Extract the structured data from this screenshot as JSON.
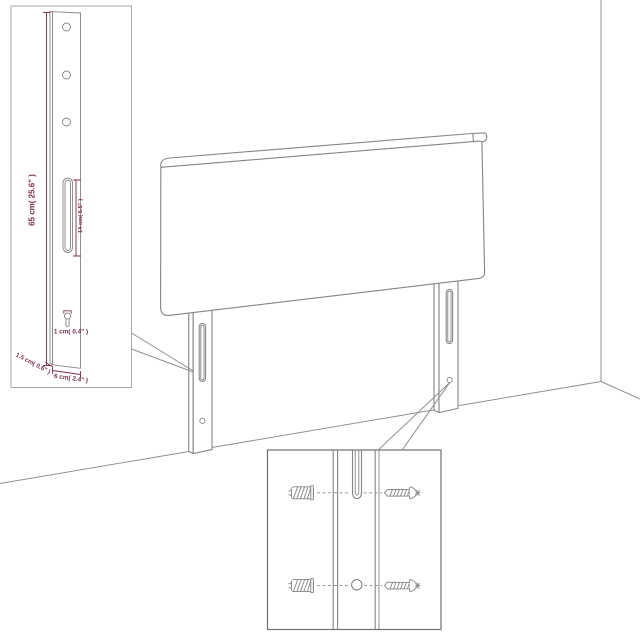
{
  "colors": {
    "background": "#ffffff",
    "outline": "#858585",
    "wall": "#909090",
    "dimension": "#7d2b50",
    "callout_border_light": "#ababab",
    "callout_border_dark": "#6f6f6f"
  },
  "callout_leg_detail": {
    "height_label": "65 cm( 25.6\" )",
    "slot_label": "14 cm( 5.5\" )",
    "hole_label": "1 cm( 0.4\" )",
    "depth_label": "1.5 cm( 0.6\" )",
    "width_label": "6 cm( 2.4\" )"
  }
}
